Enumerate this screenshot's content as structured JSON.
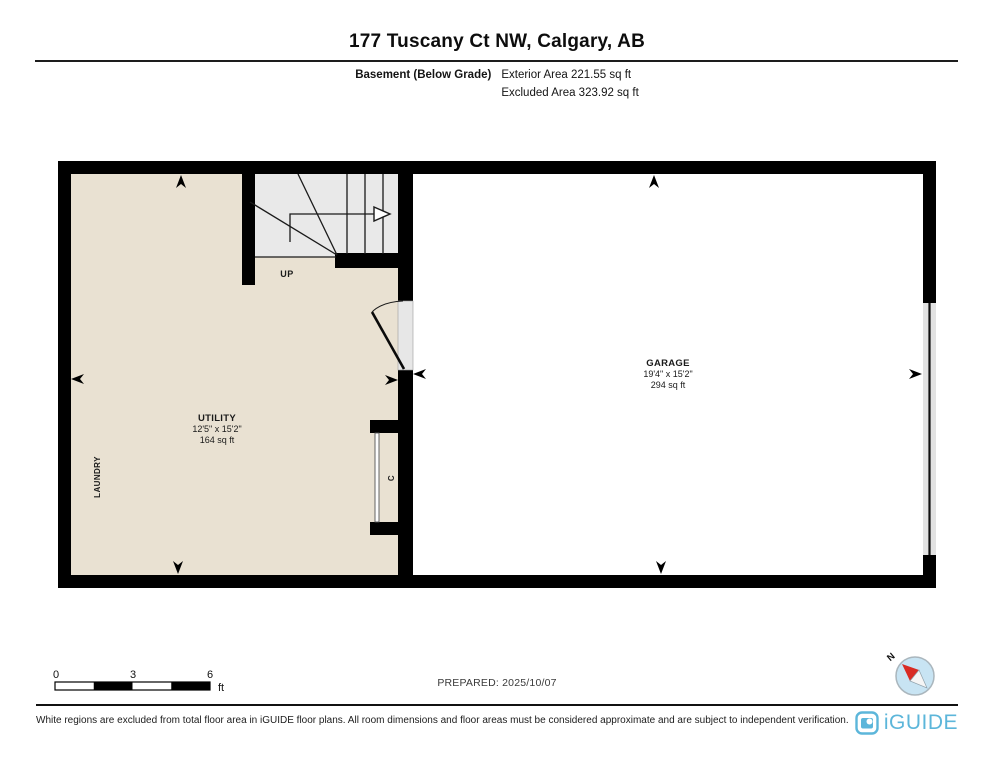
{
  "header": {
    "title": "177 Tuscany Ct NW, Calgary, AB",
    "floor_label": "Basement (Below Grade)",
    "exterior_area": "Exterior Area 221.55 sq ft",
    "excluded_area": "Excluded Area 323.92 sq ft"
  },
  "plan": {
    "rooms": [
      {
        "name": "UTILITY",
        "dimensions": "12'5\" x 15'2\"",
        "area": "164 sq ft"
      },
      {
        "name": "GARAGE",
        "dimensions": "19'4\" x 15'2\"",
        "area": "294 sq ft"
      }
    ],
    "labels": {
      "up": "UP",
      "laundry": "LAUNDRY",
      "closet": "C"
    }
  },
  "scale_bar": {
    "ticks": [
      "0",
      "3",
      "6"
    ],
    "unit": "ft"
  },
  "prepared_label": "PREPARED: 2025/10/07",
  "compass": {
    "north_label": "N"
  },
  "footer": {
    "disclaimer": "White regions are excluded from total floor area in iGUIDE floor plans. All room dimensions and floor areas must be considered approximate and are subject to independent verification.",
    "brand": "iGUIDE"
  },
  "colors": {
    "floor_fill": "#e9e1d2",
    "stair_fill": "#e9e9e9",
    "brand_blue": "#5cb6da",
    "compass_fill": "#c8e4f3",
    "needle_red": "#d92b23"
  }
}
